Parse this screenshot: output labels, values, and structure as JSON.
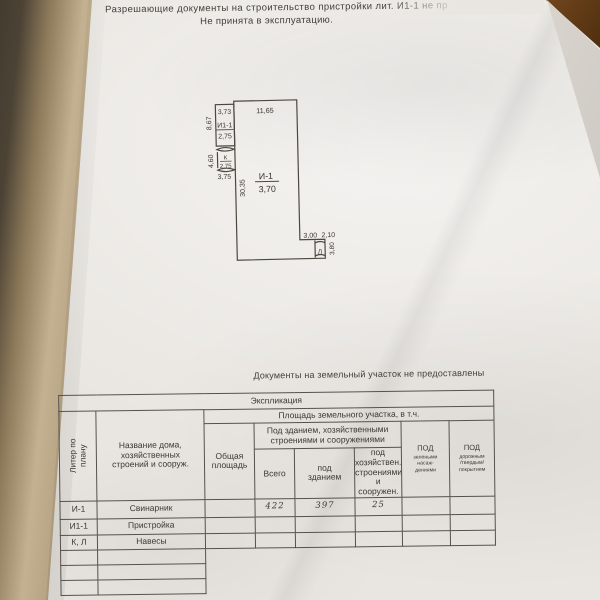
{
  "colors": {
    "paper": "#e9e6e1",
    "ink": "#3b3833",
    "plan_line": "#4d483f",
    "pencil": "#46454d",
    "wood": "#64431f",
    "curl_edge": "#b3a080"
  },
  "header": {
    "line1": "Разрешающие документы на строительство пристройки лит. И1-1 не пр",
    "line2": "Не принята в эксплуатацию."
  },
  "note": "Документы на земельный участок не предоставлены",
  "plan": {
    "dim_ext_width": "3,73",
    "dim_main_width": "11,65",
    "ext_liter": "И1-1",
    "ext_value": "2,75",
    "dim_ext_left": "8,67",
    "dim_canopy_left": "4,60",
    "canopy_liter": "К",
    "canopy_value": "2,75",
    "dim_below_canopy": "3,75",
    "dim_main_left": "30,35",
    "main_liter": "И-1",
    "main_value": "3,70",
    "dim_step_a": "3,00",
    "dim_step_b": "2,10",
    "canopy2_liter": "Л",
    "dim_canopy2": "3,80"
  },
  "table": {
    "title": "Экспликация",
    "area_group": "Площадь земельного участка, в т.ч.",
    "col_liter": "Литер по\nплану",
    "col_name": "Название дома,\nхозяйственных\nстроений и сооруж.",
    "col_total": "Общая\nплощадь",
    "under_group": "Под зданием, хозяйственными\nстроениями и сооружениями",
    "col_vsego": "Всего",
    "col_building": "под\nзданием",
    "col_household": "под хозяйствен.\nстроениями\nи сооружен.",
    "col_green_cap": "ПОД",
    "col_green_rest": "зелеными\nнасаж-\nдениями",
    "col_road_cap": "ПОД",
    "col_road_rest": "дорожным\n/твердым/\nпокрытием",
    "rows": [
      {
        "liter": "И-1",
        "name": "Свинарник",
        "total": "",
        "vsego": "422",
        "under_building": "397",
        "under_household": "25",
        "green": "",
        "road": ""
      },
      {
        "liter": "И1-1",
        "name": "Пристройка",
        "total": "",
        "vsego": "",
        "under_building": "",
        "under_household": "",
        "green": "",
        "road": ""
      },
      {
        "liter": "К, Л",
        "name": "Навесы",
        "total": "",
        "vsego": "",
        "under_building": "",
        "under_household": "",
        "green": "",
        "road": ""
      }
    ]
  }
}
